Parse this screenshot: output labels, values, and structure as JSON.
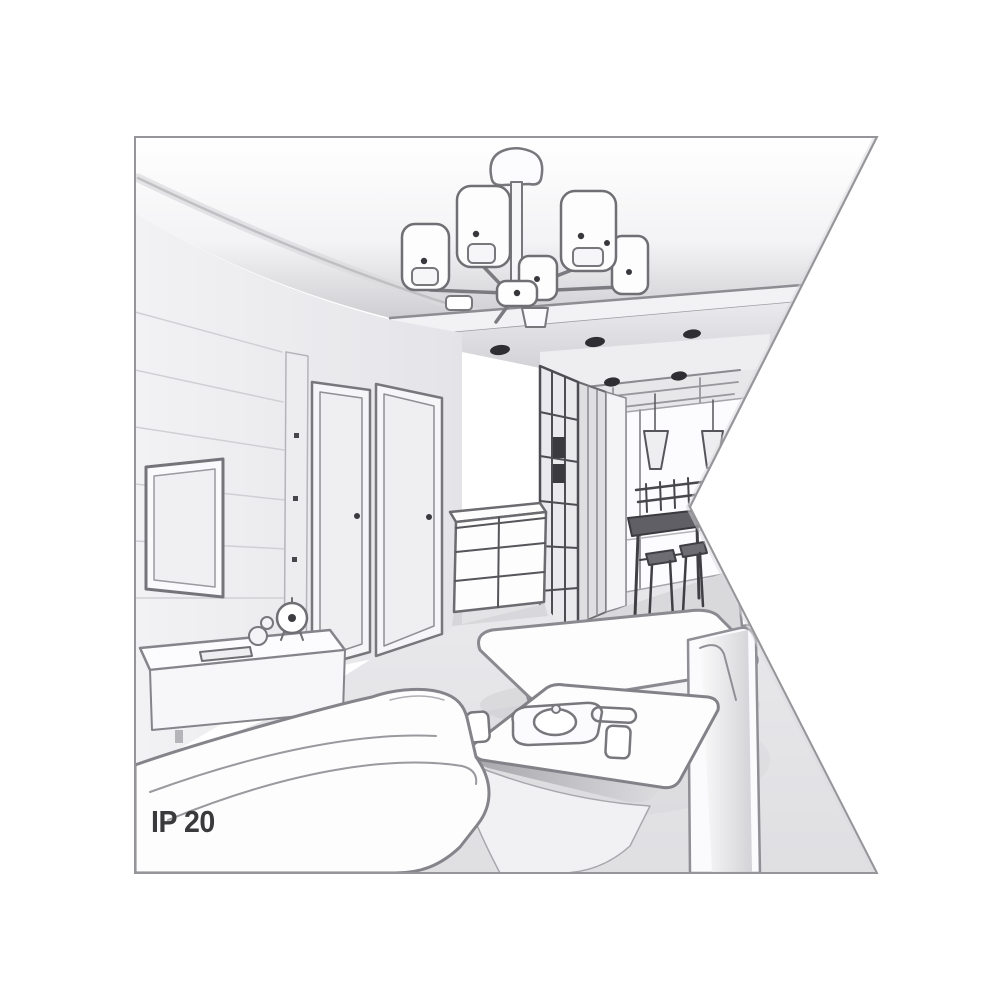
{
  "page": {
    "background": "#ffffff"
  },
  "illustration": {
    "ip_rating": "IP 20",
    "caption": "Perspective line-art drawing of a living room interior with a six-shade ceiling chandelier, clipped in a flag-shaped frame",
    "elements": [
      "chandelier",
      "ceiling-soffit-spotlights",
      "tv",
      "wall-panel",
      "media-sideboard",
      "clock",
      "ornaments",
      "remote-control",
      "interior-door",
      "interior-door-2",
      "drawer-cabinet",
      "sliding-wardrobe",
      "hallway",
      "pendant-lamps",
      "window",
      "dining-table",
      "bar-stools",
      "bench-sofa",
      "chaise",
      "coffee-table",
      "tea-tray",
      "cups",
      "sofa"
    ]
  },
  "colors": {
    "outline": "#6f6f74",
    "outline_soft": "#9a9a9e",
    "wall": "#ebebee",
    "ceiling_shade": "#c9c9cd",
    "floor": "#e3e3e6",
    "accent_dark": "#2f2f33",
    "label_text": "#3a3a3d"
  }
}
